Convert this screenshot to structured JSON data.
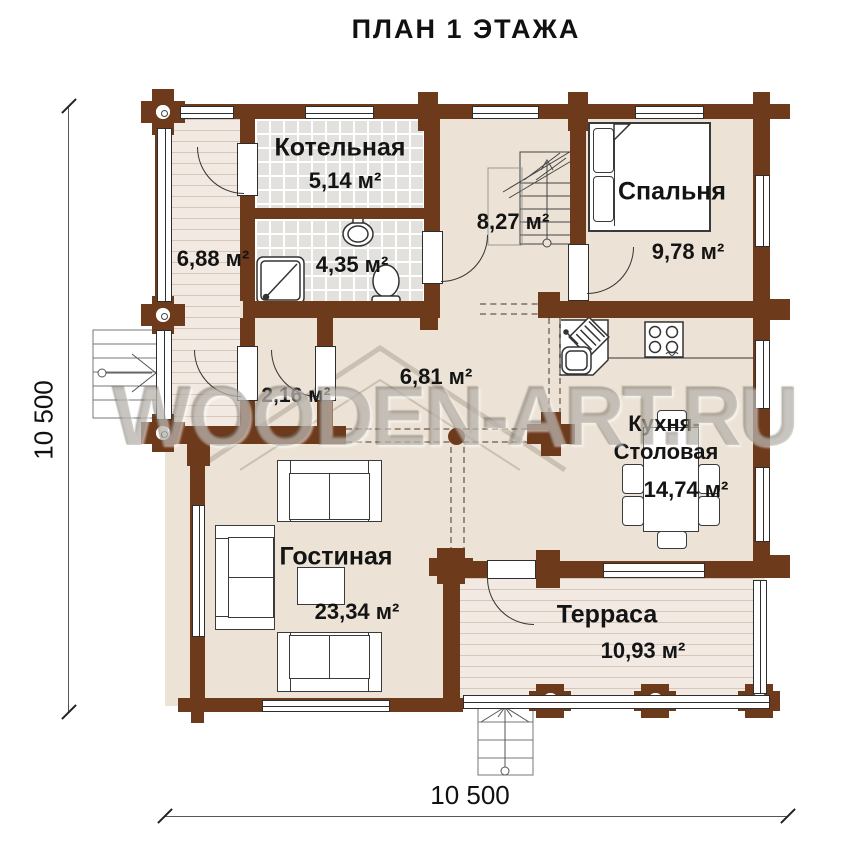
{
  "title": "ПЛАН 1 ЭТАЖА",
  "watermark": "WOODEN-ART.RU",
  "dimensions": {
    "left": "10 500",
    "bottom": "10 500"
  },
  "rooms": {
    "boiler": {
      "name": "Котельная",
      "area": "5,14 м²"
    },
    "hallway": {
      "area": "6,88 м²"
    },
    "bathroom": {
      "area": "4,35 м²"
    },
    "stair_hall": {
      "area": "8,27 м²"
    },
    "bedroom": {
      "name": "Спальня",
      "area": "9,78 м²"
    },
    "hall": {
      "area": "6,81 м²"
    },
    "vestibule": {
      "area": "2,16 м²"
    },
    "kitchen": {
      "name_line1": "Кухня-",
      "name_line2": "Столовая",
      "area": "14,74 м²"
    },
    "living": {
      "name": "Гостиная",
      "area": "23,34 м²"
    },
    "terrace": {
      "name": "Терраса",
      "area": "10,93 м²"
    }
  }
}
